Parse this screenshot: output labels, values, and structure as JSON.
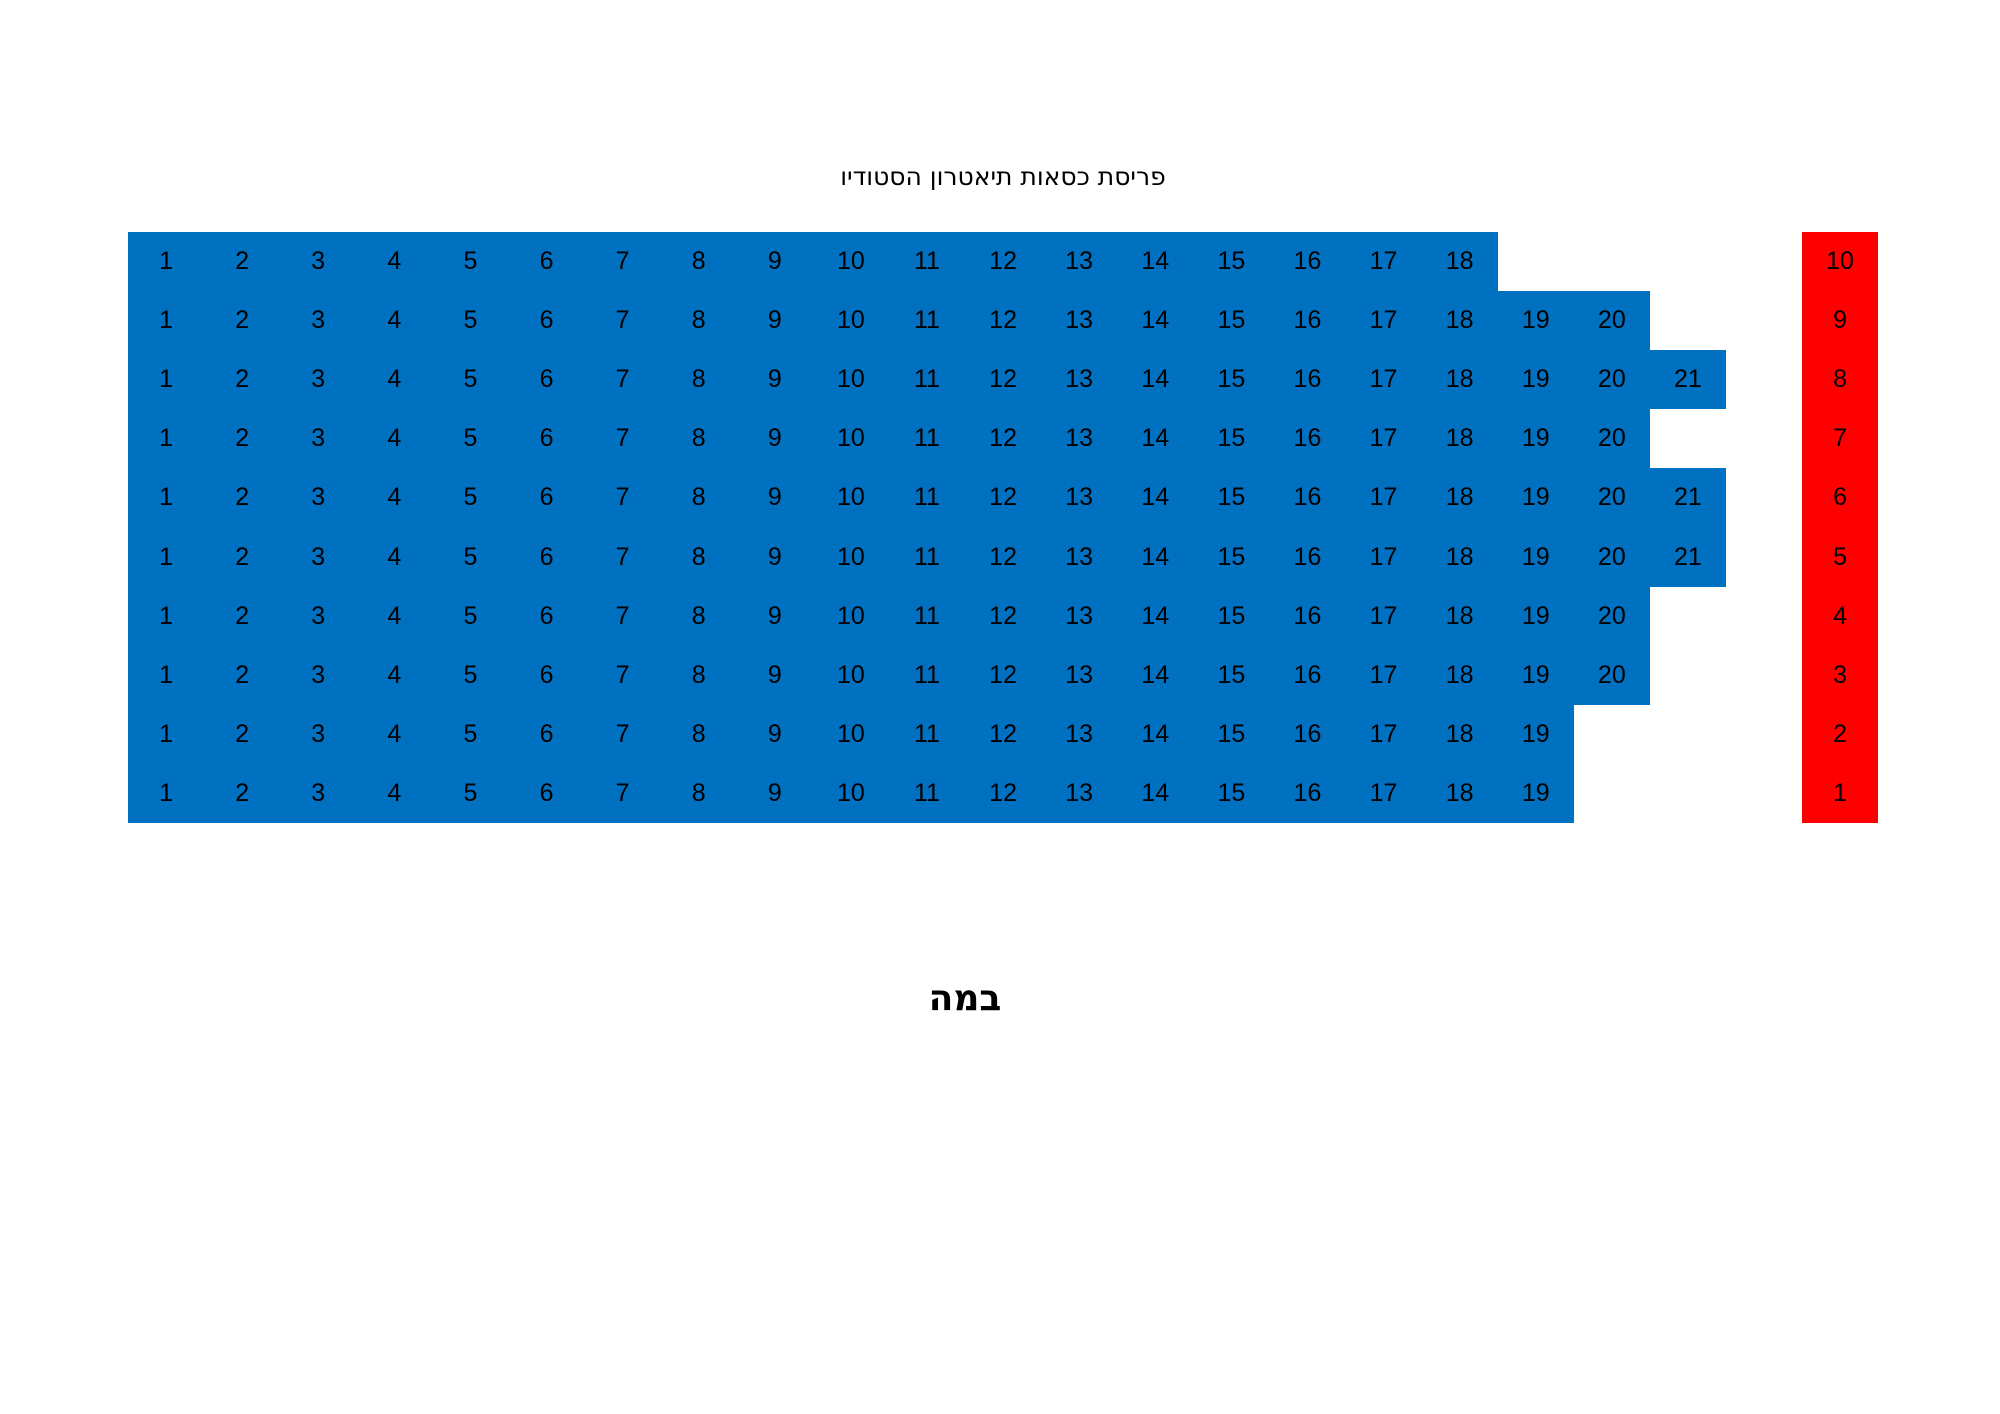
{
  "page": {
    "title": "פריסת כסאות תיאטרון הסטודיו",
    "stage_label": "במה"
  },
  "colors": {
    "seat_block_blue": "#0070C0",
    "row_label_red": "#FF0000",
    "text_black": "#000000",
    "background_white": "#FFFFFF"
  },
  "seating": {
    "rows": [
      {
        "row_label": "10",
        "seat_count": 18,
        "seat_numbers": [
          "1",
          "2",
          "3",
          "4",
          "5",
          "6",
          "7",
          "8",
          "9",
          "10",
          "11",
          "12",
          "13",
          "14",
          "15",
          "16",
          "17",
          "18"
        ]
      },
      {
        "row_label": "9",
        "seat_count": 20,
        "seat_numbers": [
          "1",
          "2",
          "3",
          "4",
          "5",
          "6",
          "7",
          "8",
          "9",
          "10",
          "11",
          "12",
          "13",
          "14",
          "15",
          "16",
          "17",
          "18",
          "19",
          "20"
        ]
      },
      {
        "row_label": "8",
        "seat_count": 21,
        "seat_numbers": [
          "1",
          "2",
          "3",
          "4",
          "5",
          "6",
          "7",
          "8",
          "9",
          "10",
          "11",
          "12",
          "13",
          "14",
          "15",
          "16",
          "17",
          "18",
          "19",
          "20",
          "21"
        ]
      },
      {
        "row_label": "7",
        "seat_count": 20,
        "seat_numbers": [
          "1",
          "2",
          "3",
          "4",
          "5",
          "6",
          "7",
          "8",
          "9",
          "10",
          "11",
          "12",
          "13",
          "14",
          "15",
          "16",
          "17",
          "18",
          "19",
          "20"
        ]
      },
      {
        "row_label": "6",
        "seat_count": 21,
        "seat_numbers": [
          "1",
          "2",
          "3",
          "4",
          "5",
          "6",
          "7",
          "8",
          "9",
          "10",
          "11",
          "12",
          "13",
          "14",
          "15",
          "16",
          "17",
          "18",
          "19",
          "20",
          "21"
        ]
      },
      {
        "row_label": "5",
        "seat_count": 21,
        "seat_numbers": [
          "1",
          "2",
          "3",
          "4",
          "5",
          "6",
          "7",
          "8",
          "9",
          "10",
          "11",
          "12",
          "13",
          "14",
          "15",
          "16",
          "17",
          "18",
          "19",
          "20",
          "21"
        ]
      },
      {
        "row_label": "4",
        "seat_count": 20,
        "seat_numbers": [
          "1",
          "2",
          "3",
          "4",
          "5",
          "6",
          "7",
          "8",
          "9",
          "10",
          "11",
          "12",
          "13",
          "14",
          "15",
          "16",
          "17",
          "18",
          "19",
          "20"
        ]
      },
      {
        "row_label": "3",
        "seat_count": 20,
        "seat_numbers": [
          "1",
          "2",
          "3",
          "4",
          "5",
          "6",
          "7",
          "8",
          "9",
          "10",
          "11",
          "12",
          "13",
          "14",
          "15",
          "16",
          "17",
          "18",
          "19",
          "20"
        ]
      },
      {
        "row_label": "2",
        "seat_count": 19,
        "seat_numbers": [
          "1",
          "2",
          "3",
          "4",
          "5",
          "6",
          "7",
          "8",
          "9",
          "10",
          "11",
          "12",
          "13",
          "14",
          "15",
          "16",
          "17",
          "18",
          "19"
        ]
      },
      {
        "row_label": "1",
        "seat_count": 19,
        "seat_numbers": [
          "1",
          "2",
          "3",
          "4",
          "5",
          "6",
          "7",
          "8",
          "9",
          "10",
          "11",
          "12",
          "13",
          "14",
          "15",
          "16",
          "17",
          "18",
          "19"
        ]
      }
    ]
  }
}
